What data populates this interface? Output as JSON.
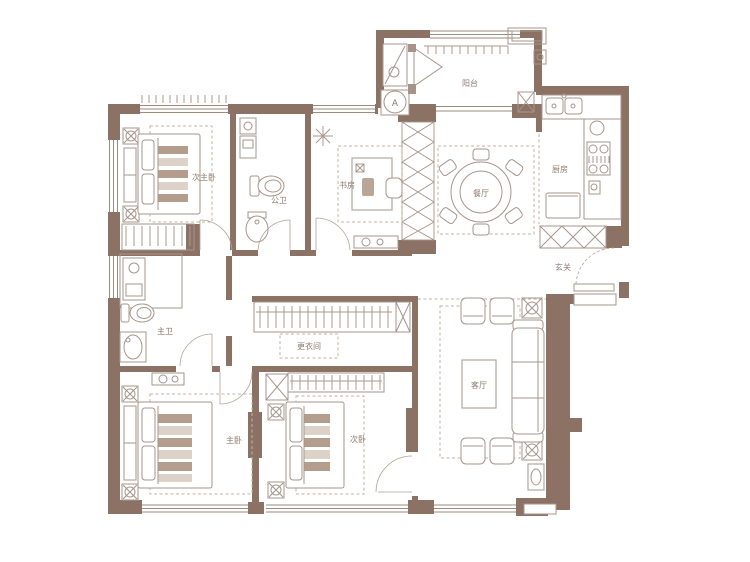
{
  "plan": {
    "type": "apartment-floor-plan",
    "rooms": [
      {
        "id": "secondary-master-bedroom",
        "label": "次主卧"
      },
      {
        "id": "guest-bathroom",
        "label": "公卫"
      },
      {
        "id": "study",
        "label": "书房"
      },
      {
        "id": "balcony",
        "label": "阳台"
      },
      {
        "id": "dining-room",
        "label": "餐厅"
      },
      {
        "id": "kitchen",
        "label": "厨房"
      },
      {
        "id": "entry",
        "label": "玄关"
      },
      {
        "id": "master-bathroom",
        "label": "主卫"
      },
      {
        "id": "dressing-room",
        "label": "更衣间"
      },
      {
        "id": "master-bedroom",
        "label": "主卧"
      },
      {
        "id": "secondary-bedroom",
        "label": "次卧"
      },
      {
        "id": "living-room",
        "label": "客厅"
      }
    ],
    "washer_label": "A",
    "icons": {
      "washing-machine-icon": "circle-A",
      "plant-icon": "eight-ray-star",
      "shaft-hatch": "x-lattice",
      "shoe-cabinet-icon": "x-boxes",
      "wardrobe-hangers-icon": "comb-ticks"
    },
    "colors": {
      "wall": "#8c7265",
      "wall_light": "#a5948a",
      "furniture_line": "#a6958b",
      "dashed_decor": "#c3b1a2",
      "stripe_dark": "#b49d8c",
      "stripe_light": "#ddd2c8",
      "label_text": "#8d7b6f",
      "background": "#ffffff"
    }
  }
}
